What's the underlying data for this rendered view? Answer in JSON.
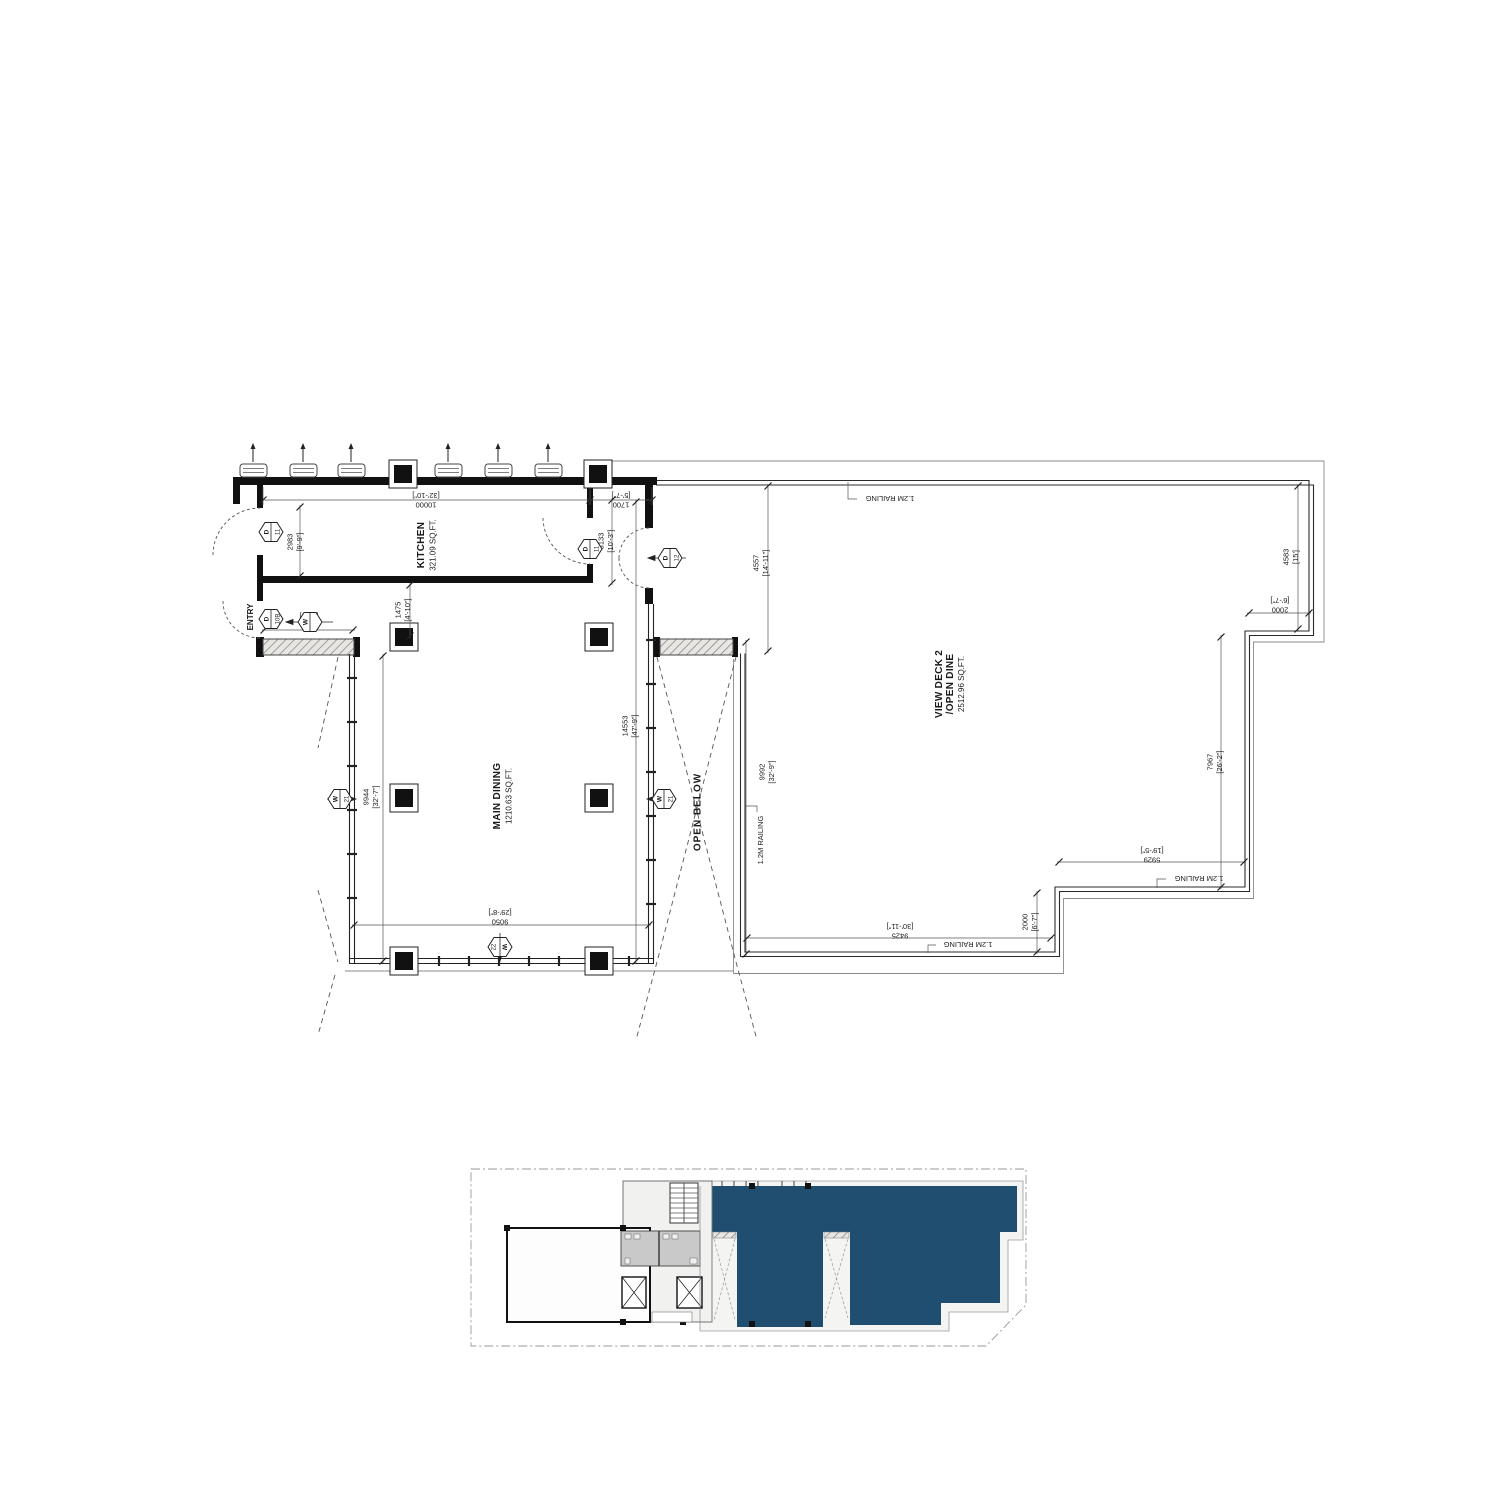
{
  "plan": {
    "rooms": {
      "kitchen": {
        "name": "KITCHEN",
        "area": "321.09 SQ.FT."
      },
      "main_dining": {
        "name": "MAIN DINING",
        "area": "1210.63 SQ.FT."
      },
      "view_deck": {
        "name": "VIEW DECK 2",
        "name2": "/OPEN DINE",
        "area": "2512.96 SQ.FT."
      },
      "open_below": "OPEN BELOW",
      "entry": "ENTRY"
    },
    "railing_label": "1.2M RAILING",
    "dims": {
      "d10000": {
        "mm": "10000",
        "ft": "[32'-10\"]"
      },
      "d1700": {
        "mm": "1700",
        "ft": "[5'-7\"]"
      },
      "d2983": {
        "mm": "2983",
        "ft": "[9'-9\"]"
      },
      "d3133": {
        "mm": "3133",
        "ft": "[10'-3\"]"
      },
      "d1475": {
        "mm": "1475",
        "ft": "[4'-10\"]"
      },
      "d2800": {
        "mm": "2800",
        "ft": "[9'-2\"]"
      },
      "d14553": {
        "mm": "14553",
        "ft": "[47'-9\"]"
      },
      "d9944": {
        "mm": "9944",
        "ft": "[32'-7\"]"
      },
      "d9050": {
        "mm": "9050",
        "ft": "[29'-8\"]"
      },
      "d4557": {
        "mm": "4557",
        "ft": "[14'-11\"]"
      },
      "d9992": {
        "mm": "9992",
        "ft": "[32'-9\"]"
      },
      "d4583": {
        "mm": "4583",
        "ft": "[15']"
      },
      "d2000": {
        "mm": "2000",
        "ft": "[6'-7\"]"
      },
      "d7967": {
        "mm": "7967",
        "ft": "[26'-2\"]"
      },
      "d5929": {
        "mm": "5929",
        "ft": "[19'-5\"]"
      },
      "d9425": {
        "mm": "9425",
        "ft": "[30'-11\"]"
      }
    },
    "tags": {
      "door_left": {
        "letter": "D",
        "number": "11"
      },
      "door_right": {
        "letter": "D",
        "number": "11"
      },
      "door_entry": {
        "letter": "D",
        "number": "10B"
      },
      "door_deck": {
        "letter": "D",
        "number": "12"
      },
      "window_side": {
        "letter": "W",
        "number": "21"
      },
      "window_bottom": {
        "letter": "W",
        "number": "22"
      }
    }
  },
  "key_plan": {
    "highlight_color": "#1f4e70"
  }
}
